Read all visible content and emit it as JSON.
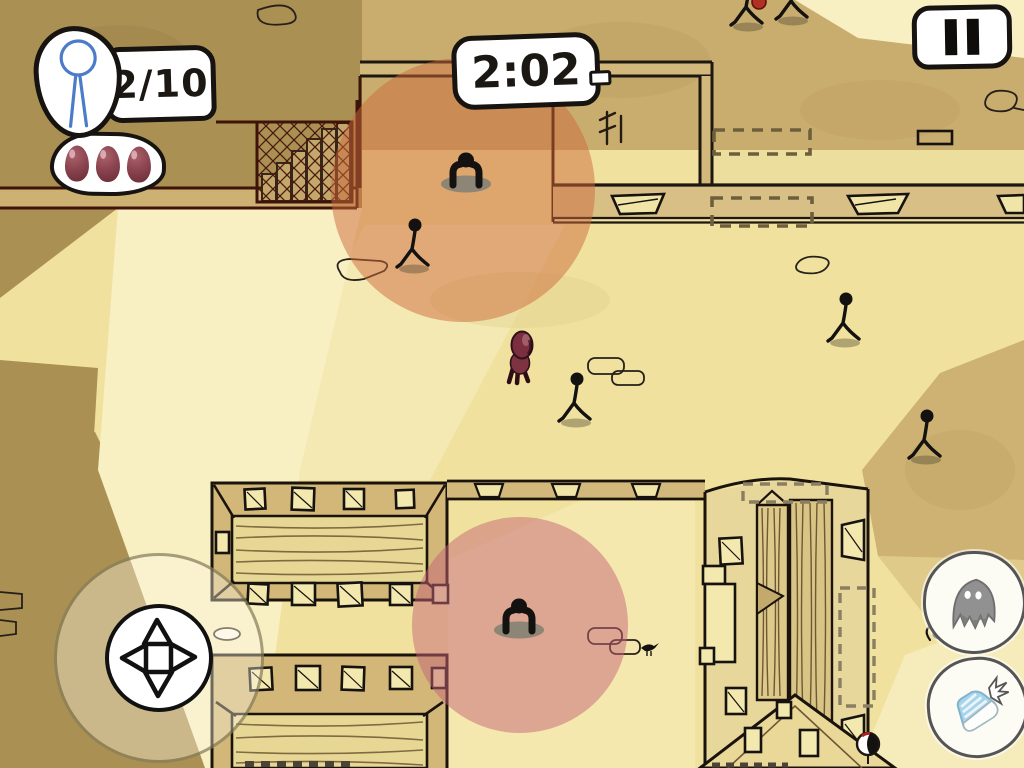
{
  "hud": {
    "character_counter": {
      "icon": "stick-figure-icon",
      "value": "2/10"
    },
    "lives": {
      "icon": "life-capsule-icon",
      "count": 3
    },
    "timer": {
      "value": "2:02"
    },
    "pause_button": {
      "icon": "pause-icon"
    }
  },
  "controls": {
    "dpad": {
      "icon": "dpad-icon",
      "directions": [
        "up",
        "right",
        "down",
        "left"
      ]
    },
    "ghost_button": {
      "icon": "ghost-icon"
    },
    "sneak_button": {
      "icon": "sneaker-icon"
    }
  },
  "world": {
    "vision_circles": [
      {
        "cx": 463,
        "cy": 190,
        "r": 132
      },
      {
        "cx": 520,
        "cy": 625,
        "r": 108
      }
    ],
    "entities": {
      "player": {
        "x": 520,
        "y": 362
      },
      "guards": [
        {
          "x": 466,
          "y": 176
        },
        {
          "x": 519,
          "y": 622
        }
      ],
      "pedestrians": [
        {
          "x": 414,
          "y": 258
        },
        {
          "x": 576,
          "y": 412
        },
        {
          "x": 845,
          "y": 332
        },
        {
          "x": 926,
          "y": 449
        },
        {
          "x": 748,
          "y": 16
        },
        {
          "x": 793,
          "y": 10
        }
      ],
      "bird": {
        "x": 648,
        "y": 648
      },
      "collectible": {
        "x": 868,
        "y": 744
      },
      "dropped_item": {
        "x": 759,
        "y": 2
      }
    }
  },
  "palette": {
    "paper": "#f0e29e",
    "paper_light": "#f8efc2",
    "khaki": "#ab9053",
    "sand": "#c9ad6f",
    "wall_face": "#d3b878",
    "roof": "#e7d795",
    "outline": "#1c1712",
    "outline_red": "#451408",
    "vision_orange": "rgba(203,106,60,0.5)",
    "vision_pink": "rgba(195,100,118,0.5)",
    "life_red": "#8c4550",
    "figure_blue": "#4b7cc9"
  }
}
